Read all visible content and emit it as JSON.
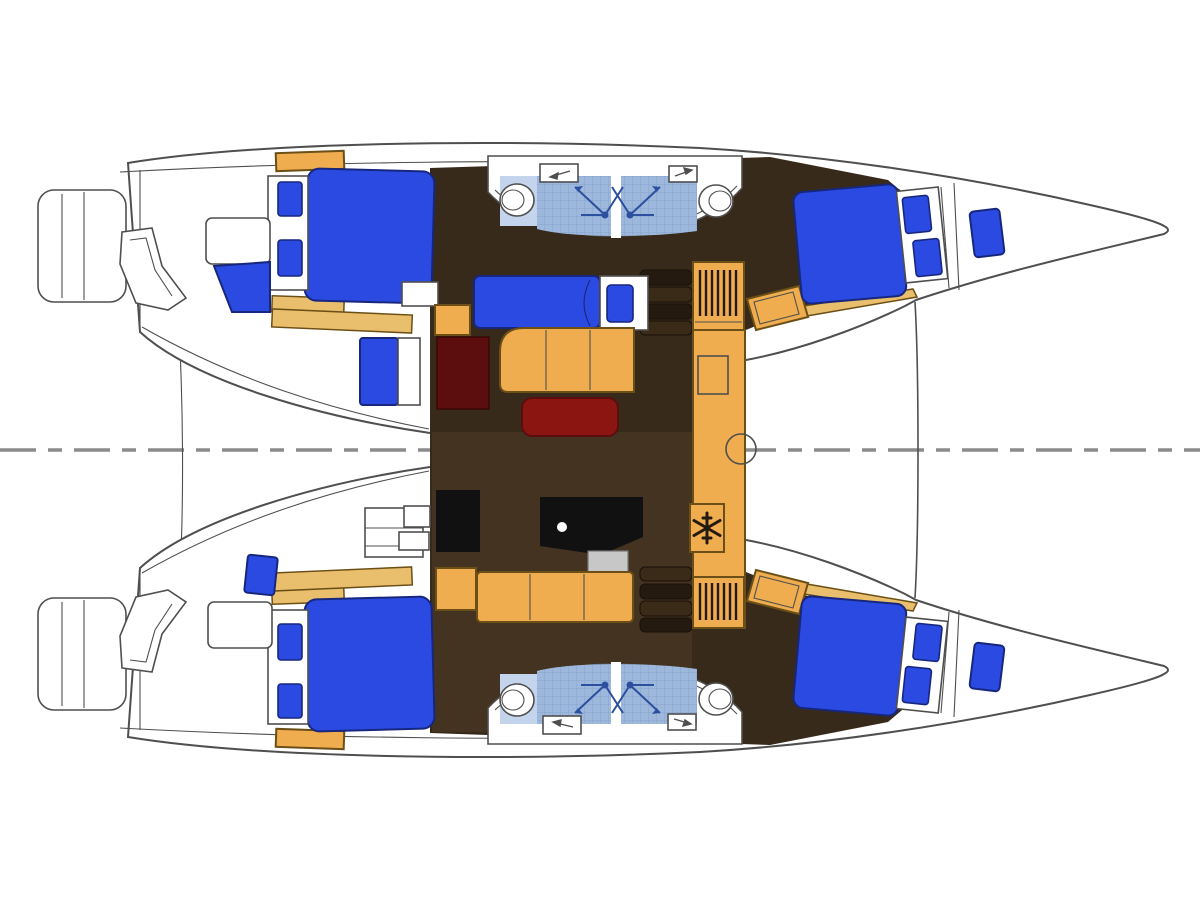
{
  "meta": {
    "title": "catamaran-yacht-deck-floor-plan",
    "view": "top-down interior layout, bows pointing right, dashed centerline",
    "canvas": {
      "width": 1200,
      "height": 900
    }
  },
  "colors": {
    "bg": "#ffffff",
    "hull": "#ffffff",
    "line": "#4f4f4f",
    "centerline": "#8a8a8a",
    "floor": "#372a1a",
    "floor_light": "#443321",
    "step_dark": "#241a10",
    "step_mid": "#3a2a18",
    "wood": "#f0ad4f",
    "wood_dark": "#6b4f16",
    "wood_band": "#e9bf6d",
    "bed": "#2b4ae2",
    "bed_dark": "#17277e",
    "maroon": "#8a1511",
    "maroon_dark": "#5c0e0e",
    "black": "#111111",
    "gray": "#c7c7c7",
    "tile": "#9db8dc",
    "tile_line": "#7f9cc8",
    "tile_light": "#c3d4ec",
    "shower": "#2c4f9e"
  },
  "layout": {
    "hulls": [
      "port-hull-top",
      "starboard-hull-bottom"
    ],
    "sterns": [
      "port-swim-platform",
      "starboard-swim-platform"
    ],
    "cabins": [
      "port-aft-cabin-double-berth",
      "port-forward-cabin-double-berth",
      "starboard-aft-cabin-double-berth",
      "starboard-forward-cabin-double-berth"
    ],
    "bathrooms": [
      {
        "name": "port-bathroom",
        "fixtures": [
          "toilet",
          "toilet",
          "shower",
          "shower",
          "vanity",
          "vanity"
        ]
      },
      {
        "name": "starboard-bathroom",
        "fixtures": [
          "toilet",
          "toilet",
          "shower",
          "shower",
          "vanity",
          "vanity"
        ]
      }
    ],
    "saloon": [
      "single-berth-settee",
      "l-shaped-sofa",
      "coffee-table",
      "storage-cabinet",
      "nav-station-desk",
      "nav-seat",
      "lower-settee",
      "companionway-steps-port",
      "companionway-steps-starboard"
    ],
    "galley": [
      "counter",
      "sink-square",
      "sink-round",
      "refrigerator",
      "louvered-locker-top",
      "louvered-locker-bottom"
    ],
    "icons": [
      "snowflake-icon",
      "shower-spray-icon",
      "toilet-icon",
      "centerline-dashes"
    ]
  }
}
